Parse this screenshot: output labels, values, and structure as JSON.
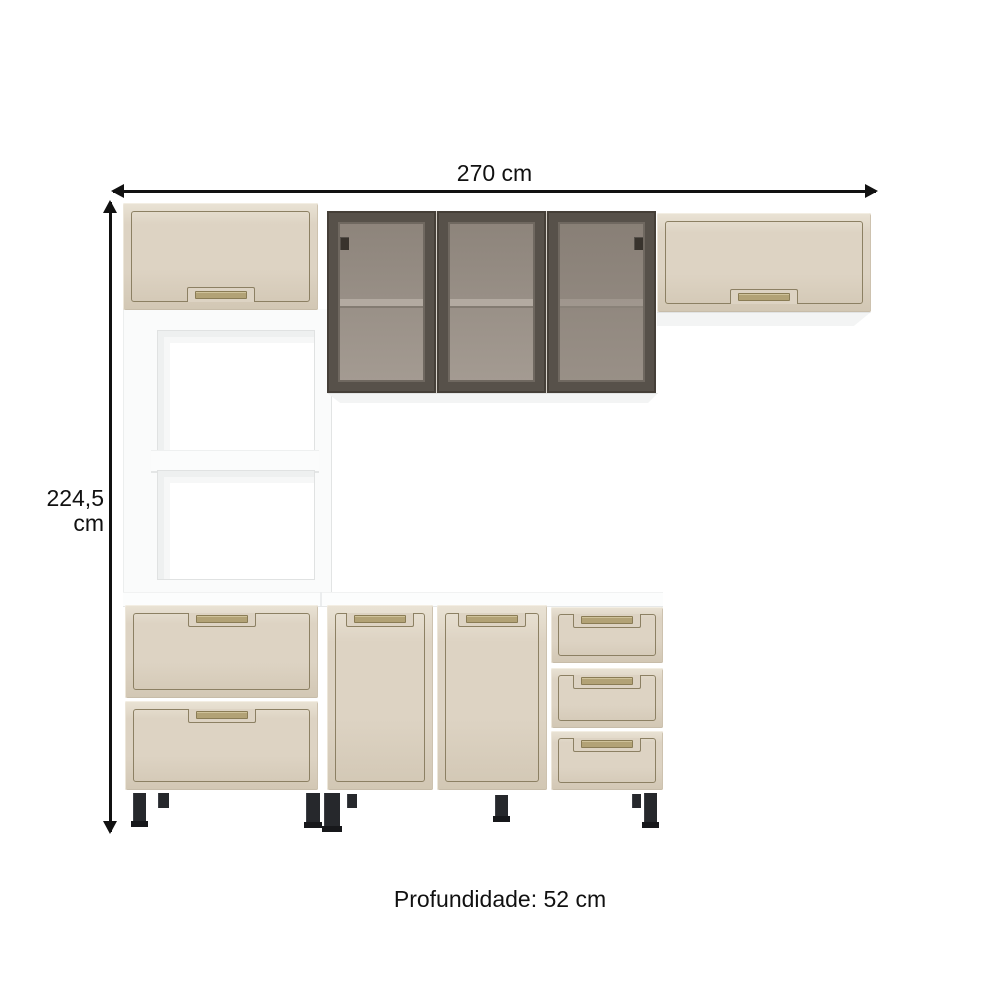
{
  "diagram": "kitchen cabinet set dimension drawing",
  "labels": {
    "width": "270 cm",
    "height": "224,5 cm",
    "depth": "Profundidade: 52 cm"
  },
  "colors": {
    "background": "#ffffff",
    "dimension-ink": "#111111",
    "cream": "#ddd3c3",
    "cream-light": "#eae3d5",
    "cream-dark": "#d2c7b4",
    "line": "#8c8063",
    "handle": "#b2a276",
    "handle-dark": "#8a7c55",
    "frame": "#57514a",
    "frame-dark": "#453f38",
    "frame-bevel": "#6f6860",
    "glass-top": "#8d847b",
    "glass-bottom": "#a49b92",
    "shelf-band": "#b3aaa1",
    "leg": "#26282c",
    "leg-foot": "#17181b"
  }
}
